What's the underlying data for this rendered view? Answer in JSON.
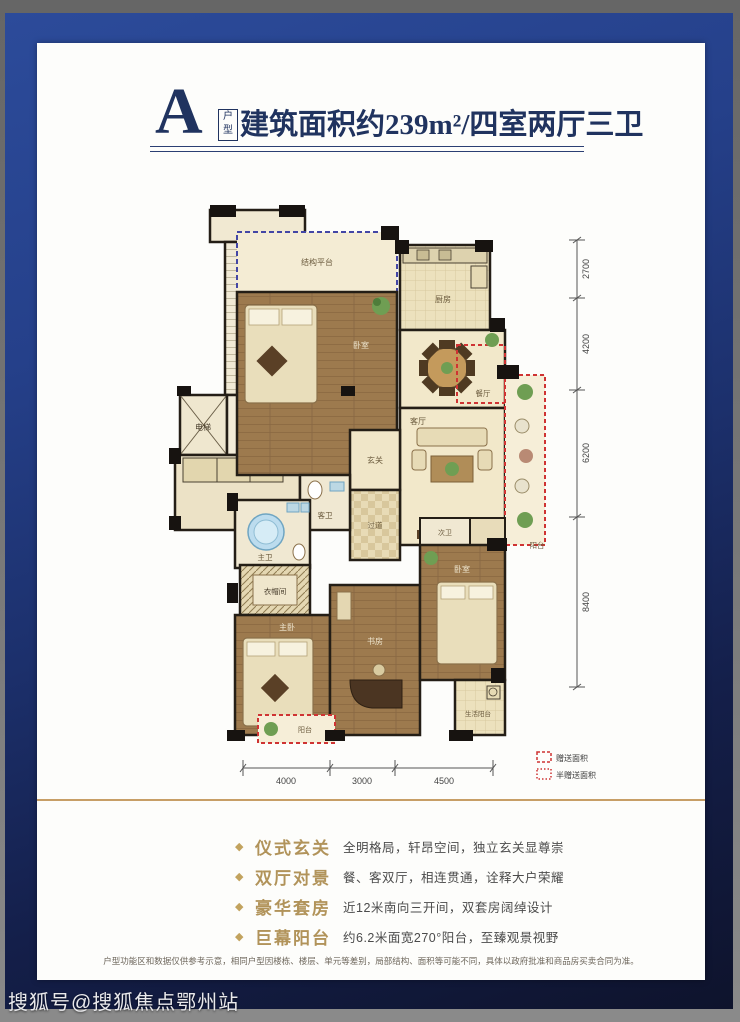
{
  "watermark": "搜狐号@搜狐焦点鄂州站",
  "header": {
    "type_letter": "A",
    "type_label_top": "户",
    "type_label_bottom": "型",
    "title": "建筑面积约239m²/四室两厅三卫"
  },
  "plan": {
    "labels": {
      "platform": "结构平台",
      "bedroom_north": "卧室",
      "kitchen": "厨房",
      "dining": "餐厅",
      "living": "客厅",
      "balcony": "阳台",
      "foyer": "玄关",
      "hallway": "过道",
      "elevator_left": "电梯",
      "elevator_right": "电梯",
      "up": "上",
      "down": "下",
      "guest_bath": "客卫",
      "master_bath": "主卫",
      "closet": "衣帽间",
      "master_bedroom": "主卧",
      "study": "书房",
      "second_bath": "次卫",
      "bedroom_se": "卧室",
      "life_balcony": "生活阳台",
      "balcony_small": "阳台"
    },
    "dims": {
      "right": [
        "2700",
        "4200",
        "6200",
        "8400"
      ],
      "bottom": [
        "4000",
        "3000",
        "4500"
      ]
    },
    "legend": {
      "full": "赠送面积",
      "half": "半赠送面积"
    }
  },
  "features": [
    {
      "bullet": "◆",
      "title": "仪式玄关",
      "desc": "全明格局，轩昂空间，独立玄关显尊崇"
    },
    {
      "bullet": "◆",
      "title": "双厅对景",
      "desc": "餐、客双厅，相连贯通，诠释大户荣耀"
    },
    {
      "bullet": "◆",
      "title": "豪华套房",
      "desc": "近12米南向三开间，双套房阔绰设计"
    },
    {
      "bullet": "◆",
      "title": "巨幕阳台",
      "desc": "约6.2米面宽270°阳台，至臻观景视野"
    }
  ],
  "disclaimer": "户型功能区和数据仅供参考示意，相同户型因楼栋、楼层、单元等差别，局部结构、面积等可能不同，具体以政府批准和商品房买卖合同为准。"
}
